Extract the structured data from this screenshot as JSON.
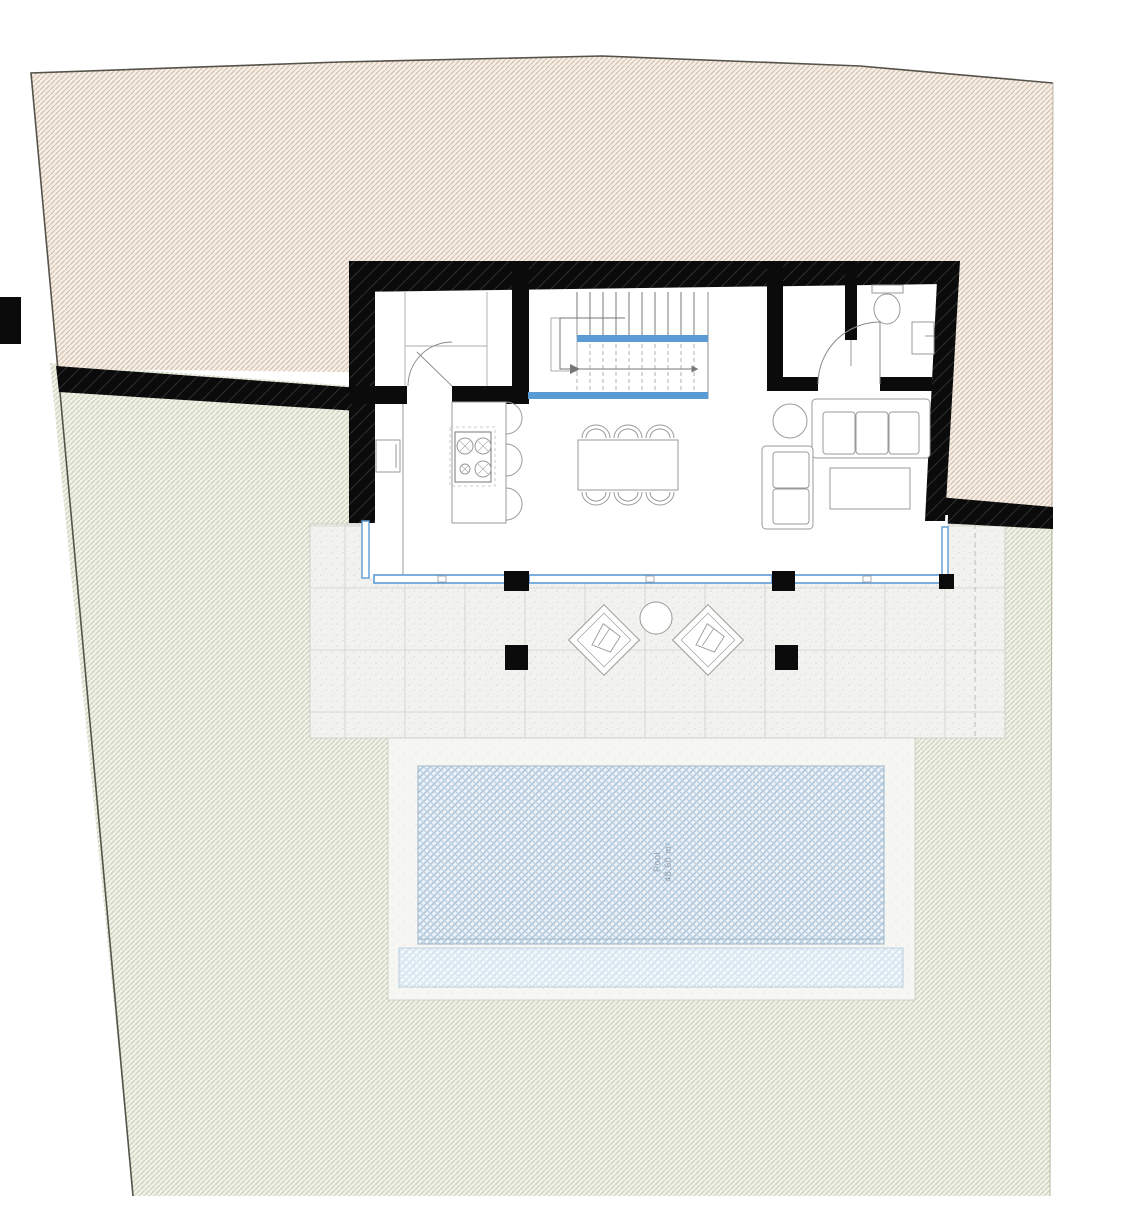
{
  "pool": {
    "label_line1": "Pool",
    "label_line2": "48,60 m²"
  },
  "colors": {
    "terrain_fill": "#f6efe5",
    "terrain_hatch": "#d6c2b1",
    "garden_fill": "#f0f2e8",
    "garden_hatch": "#cdd2bd",
    "wall": "#0b0b0b",
    "wall_hatch": "#2e2e2e",
    "glass": "#5b9bd5",
    "paving_fill": "#f2f2ef",
    "paving_light": "#f6f6f3",
    "grid_line": "#cfcfca",
    "pool_fill": "#ecf2f7",
    "pool_hatch": "#a9c2d8",
    "pool_hatch2": "#c0d3e2",
    "pool_light_fill": "#f2f7fb",
    "pool_light_hatch": "#cfdfeb",
    "furniture_line": "#9a9a9a",
    "boundary_line": "#55524a"
  }
}
